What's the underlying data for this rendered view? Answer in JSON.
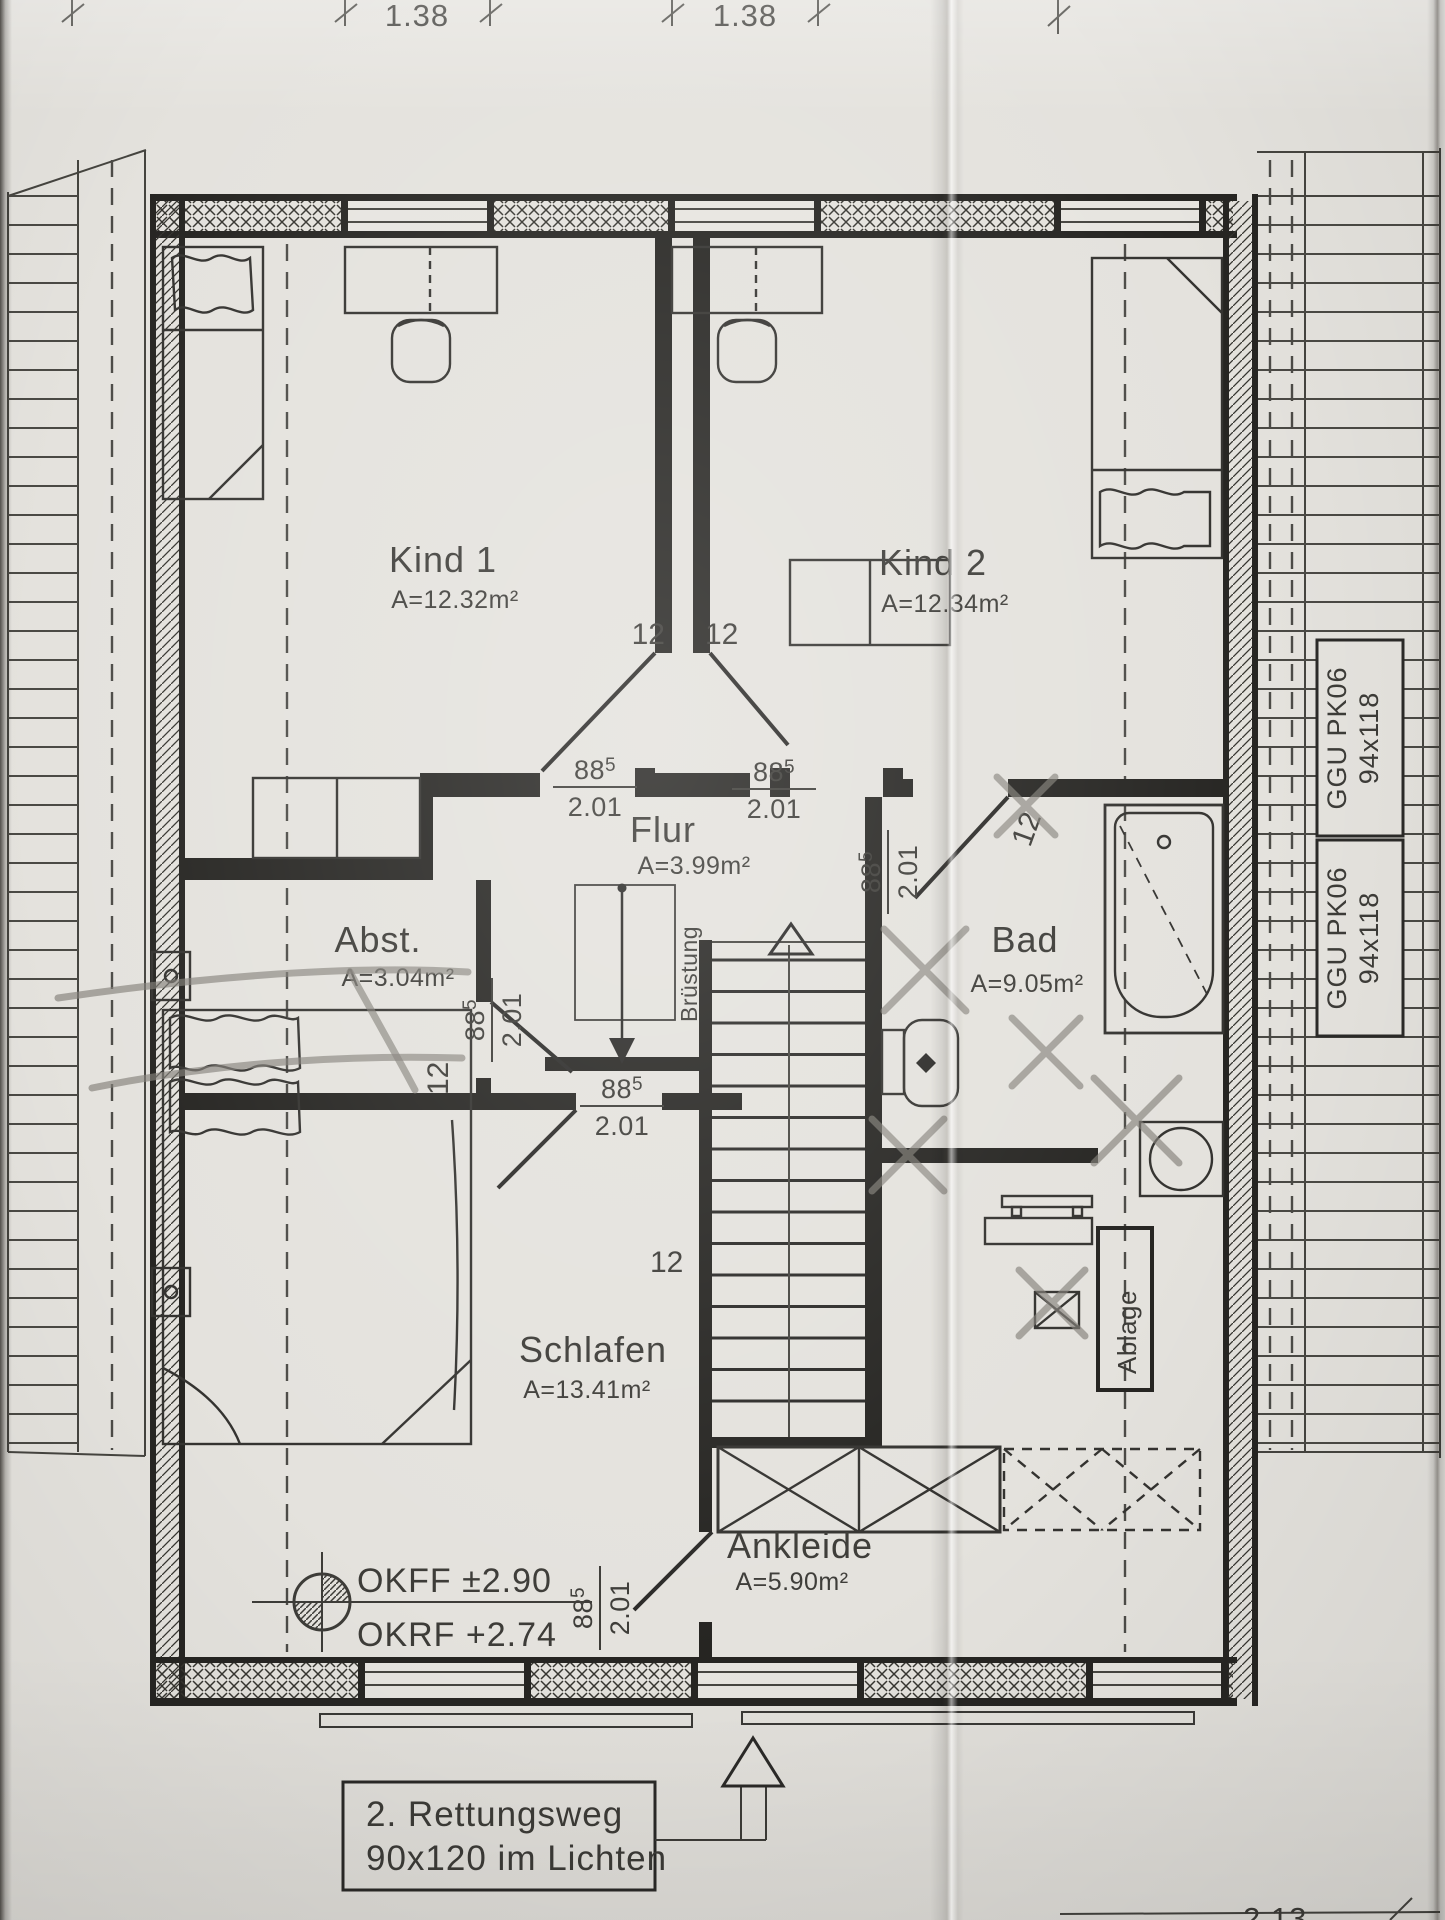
{
  "drawing": {
    "dimension_labels_top": [
      "1.38",
      "1.38"
    ],
    "dimension_label_bottom_partial": "2.13",
    "rooms": {
      "kind1": {
        "name": "Kind 1",
        "area": "A=12.32m²"
      },
      "kind2": {
        "name": "Kind 2",
        "area": "A=12.34m²"
      },
      "flur": {
        "name": "Flur",
        "area": "A=3.99m²"
      },
      "abst": {
        "name": "Abst.",
        "area": "A=3.04m²"
      },
      "bad": {
        "name": "Bad",
        "area": "A=9.05m²"
      },
      "schlafen": {
        "name": "Schlafen",
        "area": "A=13.41m²"
      },
      "ankleide": {
        "name": "Ankleide",
        "area": "A=5.90m²"
      }
    },
    "door_label": {
      "width": "88",
      "sup": "5",
      "height": "2.01"
    },
    "wall_thickness": "12",
    "bruestung": "Brüstung",
    "ablage": "Ablage",
    "levels": {
      "okff": "OKFF ±2.90",
      "okrf": "OKRF +2.74"
    },
    "roof_window": {
      "model": "GGU PK06",
      "size": "94x118"
    },
    "escape_route": {
      "line1": "2. Rettungsweg",
      "line2": "90x120 im Lichten"
    }
  }
}
